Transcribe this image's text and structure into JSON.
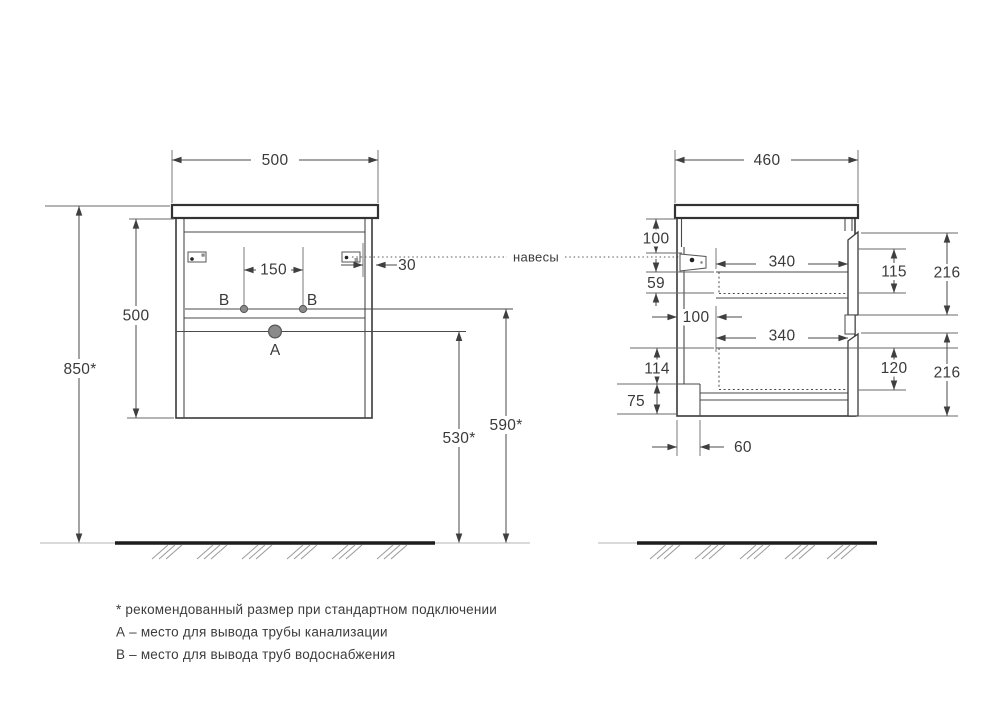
{
  "front_view": {
    "width": "500",
    "height": "500",
    "mount_height": "850*",
    "supply_spacing": "150",
    "hanger_inset": "30",
    "drain_outlet_height": "530*",
    "supply_outlet_height": "590*",
    "point_a": "A",
    "point_b_left": "B",
    "point_b_right": "B"
  },
  "side_view": {
    "depth": "460",
    "hanger_top_offset": "100",
    "hanger_bottom_gap": "59",
    "drawer_top_length": "340",
    "drawer_bottom_length": "340",
    "drawer_back_gap": "100",
    "drawer_top_inner_height": "115",
    "drawer_top_front_height": "216",
    "drawer_bottom_inner_height": "120",
    "drawer_bottom_front_height": "216",
    "back_bottom_offset": "114",
    "recess_height": "75",
    "recess_depth": "60"
  },
  "hangers_label": "навесы",
  "footnotes": [
    "* рекомендованный размер при стандартном подключении",
    "А – место для вывода трубы канализации",
    "В – место для вывода труб водоснабжения"
  ]
}
